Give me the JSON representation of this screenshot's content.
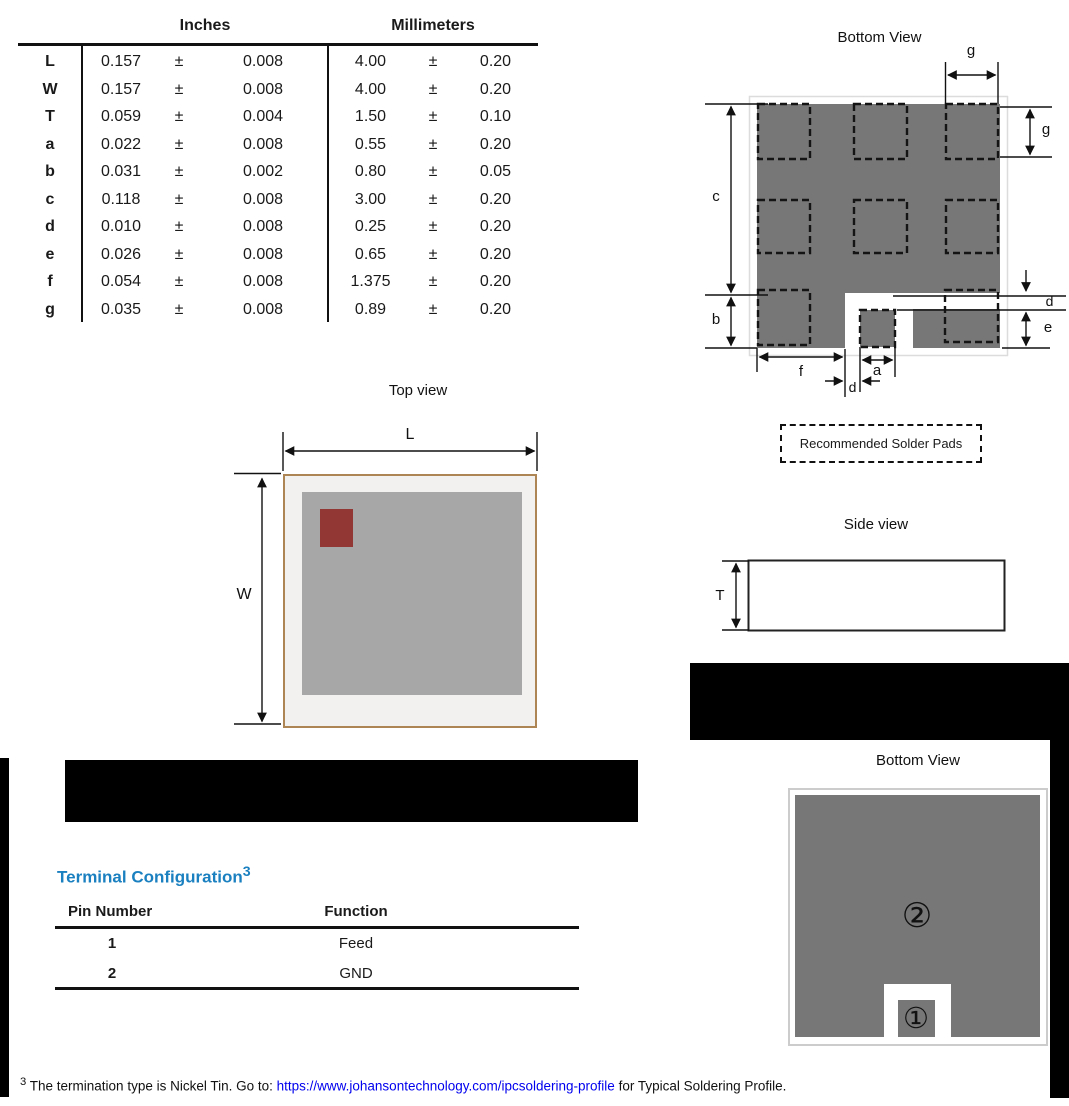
{
  "dim_table": {
    "header_inches": "Inches",
    "header_mm": "Millimeters",
    "rows": [
      {
        "p": "L",
        "iv": "0.157",
        "ipm": "±",
        "it": "0.008",
        "mv": "4.00",
        "mpm": "±",
        "mt": "0.20"
      },
      {
        "p": "W",
        "iv": "0.157",
        "ipm": "±",
        "it": "0.008",
        "mv": "4.00",
        "mpm": "±",
        "mt": "0.20"
      },
      {
        "p": "T",
        "iv": "0.059",
        "ipm": "±",
        "it": "0.004",
        "mv": "1.50",
        "mpm": "±",
        "mt": "0.10"
      },
      {
        "p": "a",
        "iv": "0.022",
        "ipm": "±",
        "it": "0.008",
        "mv": "0.55",
        "mpm": "±",
        "mt": "0.20"
      },
      {
        "p": "b",
        "iv": "0.031",
        "ipm": "±",
        "it": "0.002",
        "mv": "0.80",
        "mpm": "±",
        "mt": "0.05"
      },
      {
        "p": "c",
        "iv": "0.118",
        "ipm": "±",
        "it": "0.008",
        "mv": "3.00",
        "mpm": "±",
        "mt": "0.20"
      },
      {
        "p": "d",
        "iv": "0.010",
        "ipm": "±",
        "it": "0.008",
        "mv": "0.25",
        "mpm": "±",
        "mt": "0.20"
      },
      {
        "p": "e",
        "iv": "0.026",
        "ipm": "±",
        "it": "0.008",
        "mv": "0.65",
        "mpm": "±",
        "mt": "0.20"
      },
      {
        "p": "f",
        "iv": "0.054",
        "ipm": "±",
        "it": "0.008",
        "mv": "1.375",
        "mpm": "±",
        "mt": "0.20"
      },
      {
        "p": "g",
        "iv": "0.035",
        "ipm": "±",
        "it": "0.008",
        "mv": "0.89",
        "mpm": "±",
        "mt": "0.20"
      }
    ]
  },
  "bottom_view_pads": {
    "title": "Bottom View",
    "labels": {
      "g_top": "g",
      "g_right": "g",
      "c": "c",
      "b": "b",
      "d_right": "d",
      "e": "e",
      "f": "f",
      "a": "a",
      "d_bottom": "d"
    },
    "note": "Recommended Solder Pads"
  },
  "top_view": {
    "title": "Top view",
    "labels": {
      "l": "L",
      "w": "W"
    }
  },
  "side_view": {
    "title": "Side view",
    "labels": {
      "t": "T"
    }
  },
  "terminal_config": {
    "heading": "Terminal Configuration",
    "heading_sup": "3",
    "table": {
      "col1": "Pin Number",
      "col2": "Function",
      "rows": [
        {
          "pin": "1",
          "fn": "Feed"
        },
        {
          "pin": "2",
          "fn": "GND"
        }
      ]
    }
  },
  "bottom_view_pins": {
    "title": "Bottom View",
    "pin1_symbol": "①",
    "pin2_symbol": "②"
  },
  "footnote": {
    "sup": "3",
    "pre": " The termination type is Nickel Tin. Go to: ",
    "link": "https://www.johansontechnology.com/ipcsoldering-profile",
    "post": " for Typical Soldering Profile."
  },
  "colors": {
    "pad_gray": "#777777",
    "chip_top_gray": "#a7a7a7",
    "chip_body_fill": "#f2f1ef",
    "chip_body_border": "#ad8554",
    "accent_red": "#933734",
    "heading_blue": "#1b80c0",
    "link_blue": "#0000ee",
    "redaction": "#000000"
  }
}
